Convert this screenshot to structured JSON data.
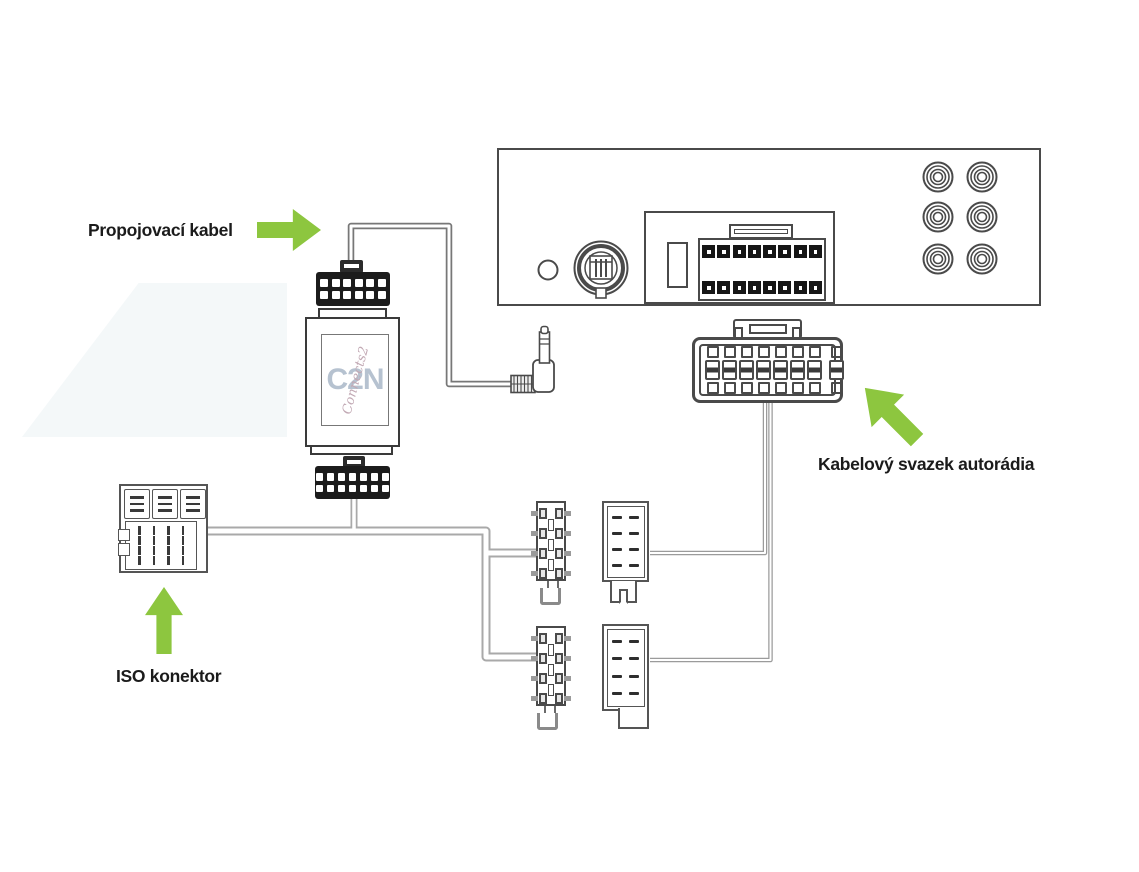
{
  "labels": {
    "connecting_cable": "Propojovací kabel",
    "radio_harness": "Kabelový svazek autorádia",
    "iso_connector": "ISO konektor"
  },
  "adapter": {
    "logo_main": "C2N",
    "logo_script": "Connects2"
  },
  "colors": {
    "arrow_green": "#8dc63f",
    "line_gray": "#4a4a4a",
    "wire_gray": "#a9a9a9"
  },
  "components": {
    "radio_rear_panel": {
      "rca_jacks": 6,
      "pin_block_pins": 16,
      "antenna_socket": 1,
      "aux_jack_hole": 1
    },
    "adapter_interface": {
      "top_connector_pins": 12,
      "bottom_connector_pins": 14
    },
    "harness_connector": {
      "terminal_columns": 8,
      "terminal_rows": 2
    },
    "male_connectors": 2,
    "female_connectors": 2,
    "iso_connector": {
      "tick_pins": 16,
      "key_blocks": 3
    },
    "jack_plug": "right-angle 3.5mm jack"
  },
  "counts": {
    "adapter_top": 6,
    "adapter_bottom": 7,
    "radio_pins": 8,
    "harness_cols": 8,
    "male_rows": 4,
    "male_mid_slots": 3,
    "female_dashes": 8,
    "iso_blocks": 3,
    "iso_block_dashes": 3,
    "iso_ticks": 16
  }
}
